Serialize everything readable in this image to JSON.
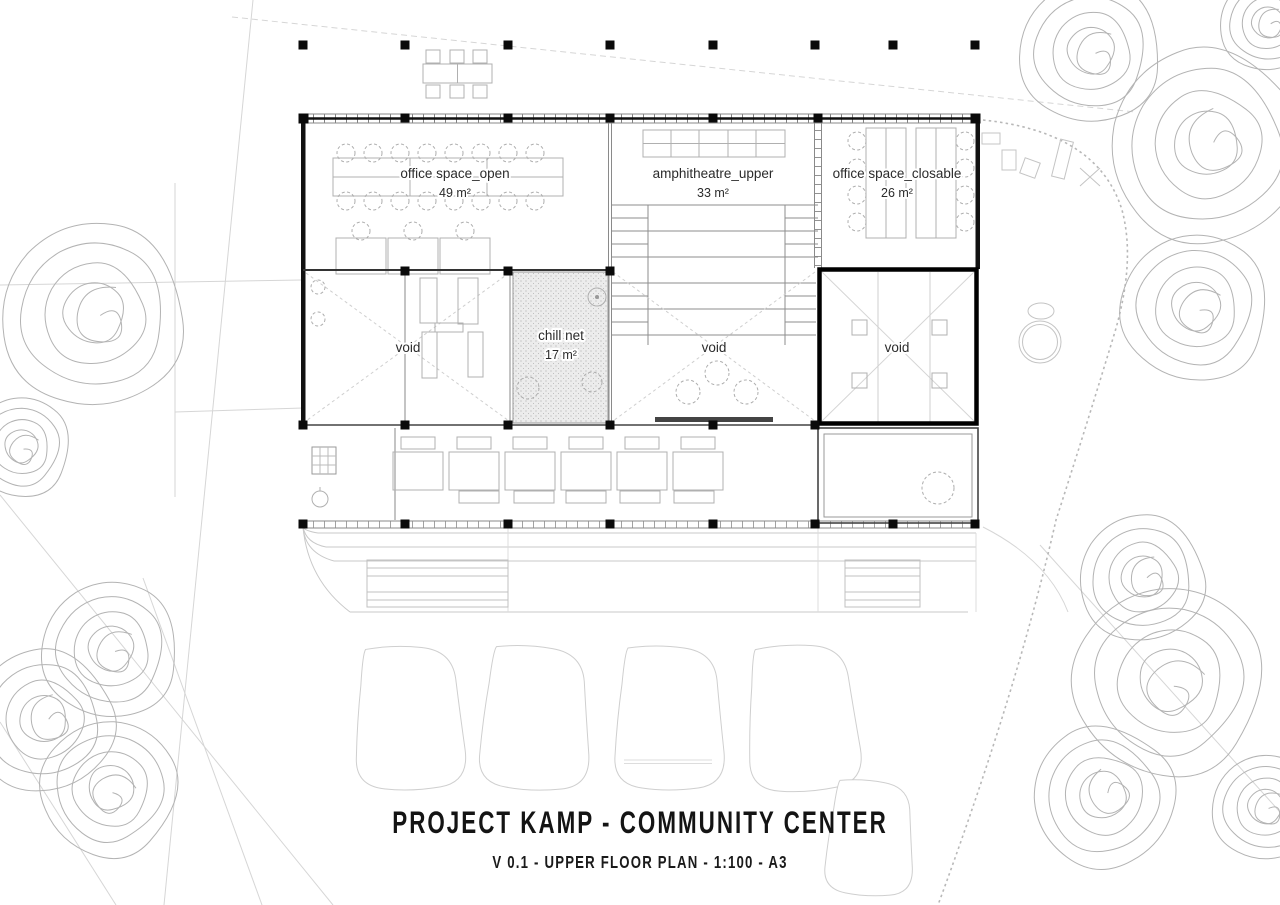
{
  "rooms": {
    "office_open": {
      "name": "office space_open",
      "area": "49 m²"
    },
    "amphitheatre": {
      "name": "amphitheatre_upper",
      "area": "33 m²"
    },
    "office_closable": {
      "name": "office space_closable",
      "area": "26 m²"
    },
    "void_left": {
      "name": "void"
    },
    "chill_net": {
      "name": "chill net",
      "area": "17 m²"
    },
    "void_center": {
      "name": "void"
    },
    "void_right": {
      "name": "void"
    }
  },
  "title_block": {
    "title": "PROJECT KAMP - COMMUNITY CENTER",
    "subtitle": "V 0.1 - UPPER FLOOR PLAN - 1:100 - A3"
  },
  "colors": {
    "wall": "#111111",
    "line_medium": "#777777",
    "furniture": "#b0b0b0",
    "faint": "#d2d2d2",
    "hatch_fill": "#ececec",
    "label": "#2b2b2b"
  }
}
